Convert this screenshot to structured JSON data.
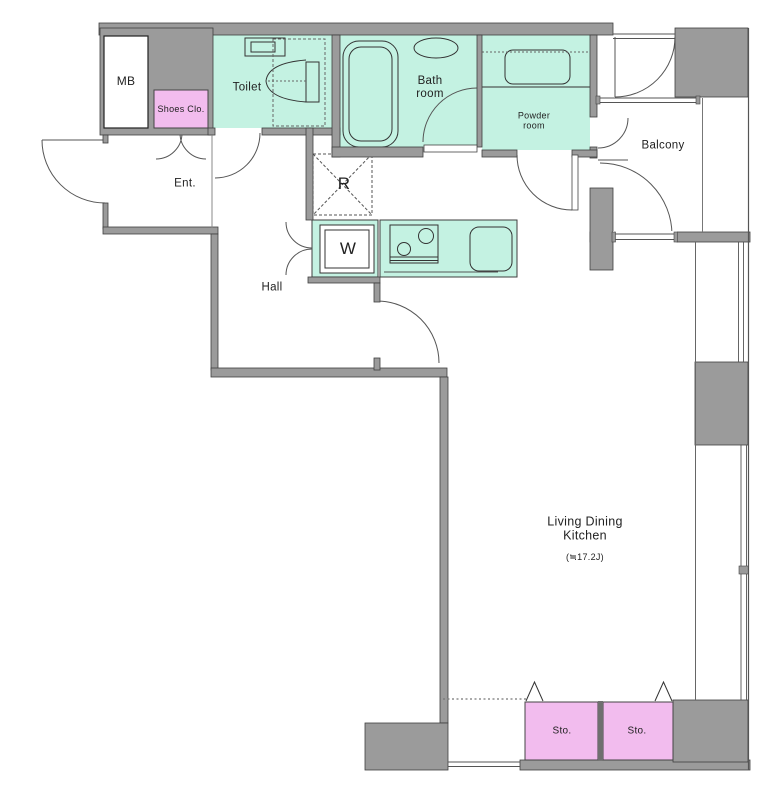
{
  "plan": {
    "title": "Apartment floor plan",
    "rooms": {
      "mb": {
        "label": "MB"
      },
      "shoes_closet": {
        "label": "Shoes  Clo."
      },
      "toilet": {
        "label": "Toilet"
      },
      "bathroom": {
        "label": "Bath\nroom"
      },
      "powder_room": {
        "label": "Powder\nroom"
      },
      "balcony": {
        "label": "Balcony"
      },
      "entrance": {
        "label": "Ent."
      },
      "hall": {
        "label": "Hall"
      },
      "refrigerator_space": {
        "label": "R"
      },
      "washer_space": {
        "label": "W"
      },
      "ldk": {
        "label": "Living Dining\nKitchen",
        "area": "(≒17.2J)"
      },
      "storage_left": {
        "label": "Sto."
      },
      "storage_right": {
        "label": "Sto."
      }
    },
    "colors": {
      "wall": "#9b9b9b",
      "wet_area": "#c4f2e2",
      "storage": "#f2bcee",
      "line": "#3f3f3f",
      "background": "#ffffff"
    }
  }
}
